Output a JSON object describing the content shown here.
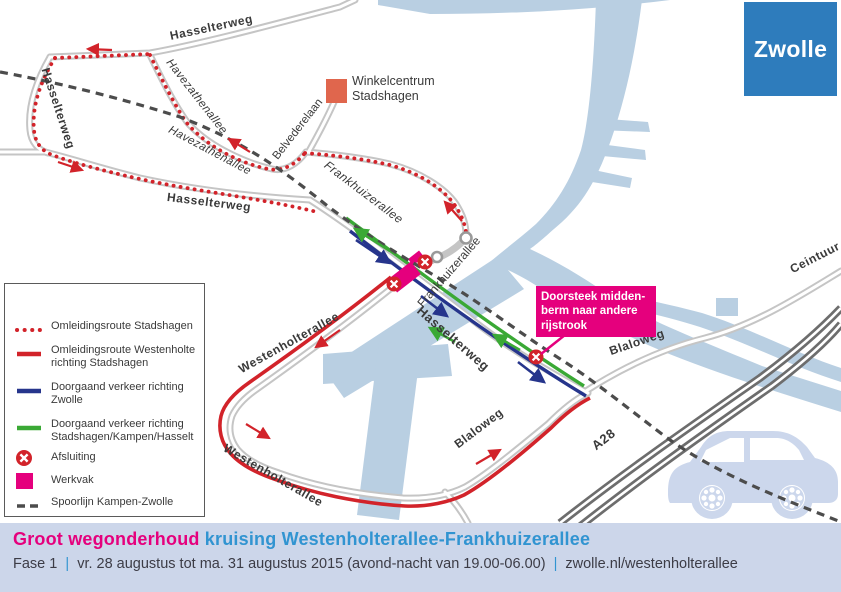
{
  "logo": {
    "text": "Zwolle"
  },
  "map": {
    "labels": {
      "hasselterweg_top": "Hasselterweg",
      "hasselterweg_left": "Hasselterweg",
      "havezathenallee_1": "Havezathenallee",
      "havezathenallee_2": "Havezathenallee",
      "hasselterweg_bottom": "Hasselterweg",
      "belvederelaan": "Belvederelaan",
      "frankhuizerallee_nw": "Frankhuizerallee",
      "frankhuizerallee_cross": "Frankhuizerallee",
      "hasselterweg_cross": "Hasselterweg",
      "westenholterallee_nw": "Westenholterallee",
      "westenholterallee_s": "Westenholterallee",
      "blaloweg_sw": "Blaloweg",
      "blaloweg_ne": "Blaloweg",
      "a28": "A28",
      "ceintuurbaan": "Ceintuur"
    },
    "poi": {
      "line1": "Winkelcentrum",
      "line2": "Stadshagen"
    },
    "callout": {
      "line1": "Doorsteek midden-",
      "line2": "berm naar andere",
      "line3": "rijstrook"
    }
  },
  "legend": {
    "items": [
      {
        "line1": "Omleidingsroute Stadshagen",
        "line2": ""
      },
      {
        "line1": "Omleidingsroute Westenholte",
        "line2": "richting Stadshagen"
      },
      {
        "line1": "Doorgaand verkeer richting",
        "line2": "Zwolle"
      },
      {
        "line1": "Doorgaand verkeer richting",
        "line2": "Stadshagen/Kampen/Hasselt"
      },
      {
        "line1": "Afsluiting",
        "line2": ""
      },
      {
        "line1": "Werkvak",
        "line2": ""
      },
      {
        "line1": "Spoorlijn Kampen-Zwolle",
        "line2": ""
      }
    ]
  },
  "footer": {
    "title_pink": "Groot wegonderhoud",
    "title_blue": "kruising Westenholterallee-Frankhuizerallee",
    "phase": "Fase 1",
    "sep": "|",
    "date": "vr. 28 augustus tot ma. 31 augustus 2015 (avond-nacht van 19.00-06.00)",
    "site": "zwolle.nl/westenholterallee"
  },
  "colors": {
    "detour_red": "#d2232a",
    "through_green": "#3aa935",
    "through_blue": "#26358c",
    "werkvak_magenta": "#e5007d",
    "water_blue": "#b9cfe2",
    "road_gray": "#c5c5c5",
    "highway_gray": "#6d6d6d",
    "rail_gray": "#4c4c4c",
    "bar_background": "#ccd6ea",
    "title_blue": "#3194d1",
    "logo_blue": "#2e7cbc",
    "poi_orange": "#e0664d"
  }
}
